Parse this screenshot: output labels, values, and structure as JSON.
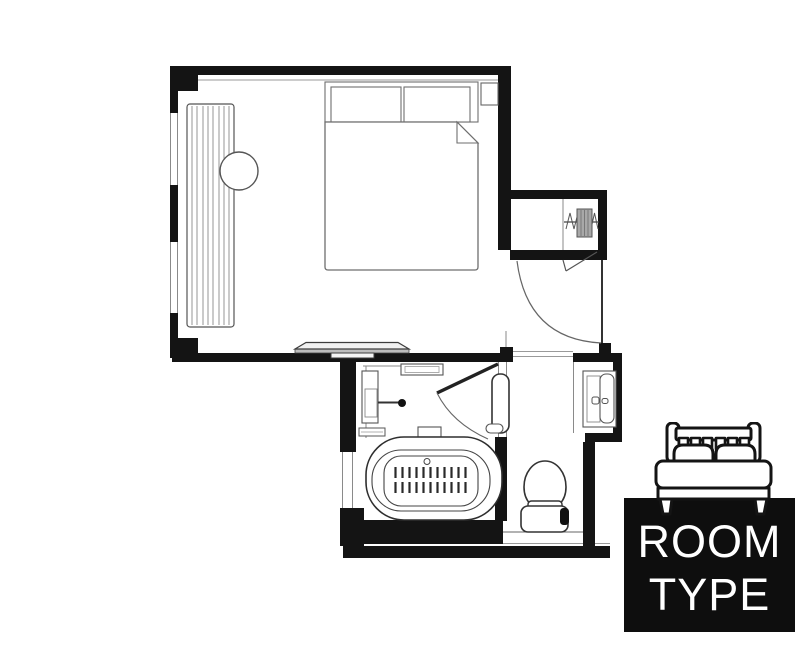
{
  "page": {
    "background": "#ffffff",
    "kind": "hotel room floor plan"
  },
  "palette": {
    "ink": "#1a1a1a",
    "wall_fill": "#141414",
    "thin_line": "#888888",
    "fixture_line": "#555555",
    "desk_fill": "#ededed",
    "label_bg": "#0e0e0e",
    "label_text": "#ffffff"
  },
  "label_card": {
    "line1": "ROOM",
    "line2": "TYPE",
    "icon": "double-bed-icon"
  },
  "floorplan": {
    "fixtures": [
      "double-bed",
      "pillows",
      "folded-sheet-corner",
      "nightstand",
      "window-curtain-blinds",
      "round-side-table",
      "console-desk",
      "closet-with-hangers",
      "entry-door-swing",
      "bathroom-door-swing",
      "door-handle-rail",
      "wall-sink",
      "shelf",
      "towel-bar",
      "bathtub-with-mat",
      "hand-shower",
      "vanity-basin",
      "toilet"
    ]
  }
}
